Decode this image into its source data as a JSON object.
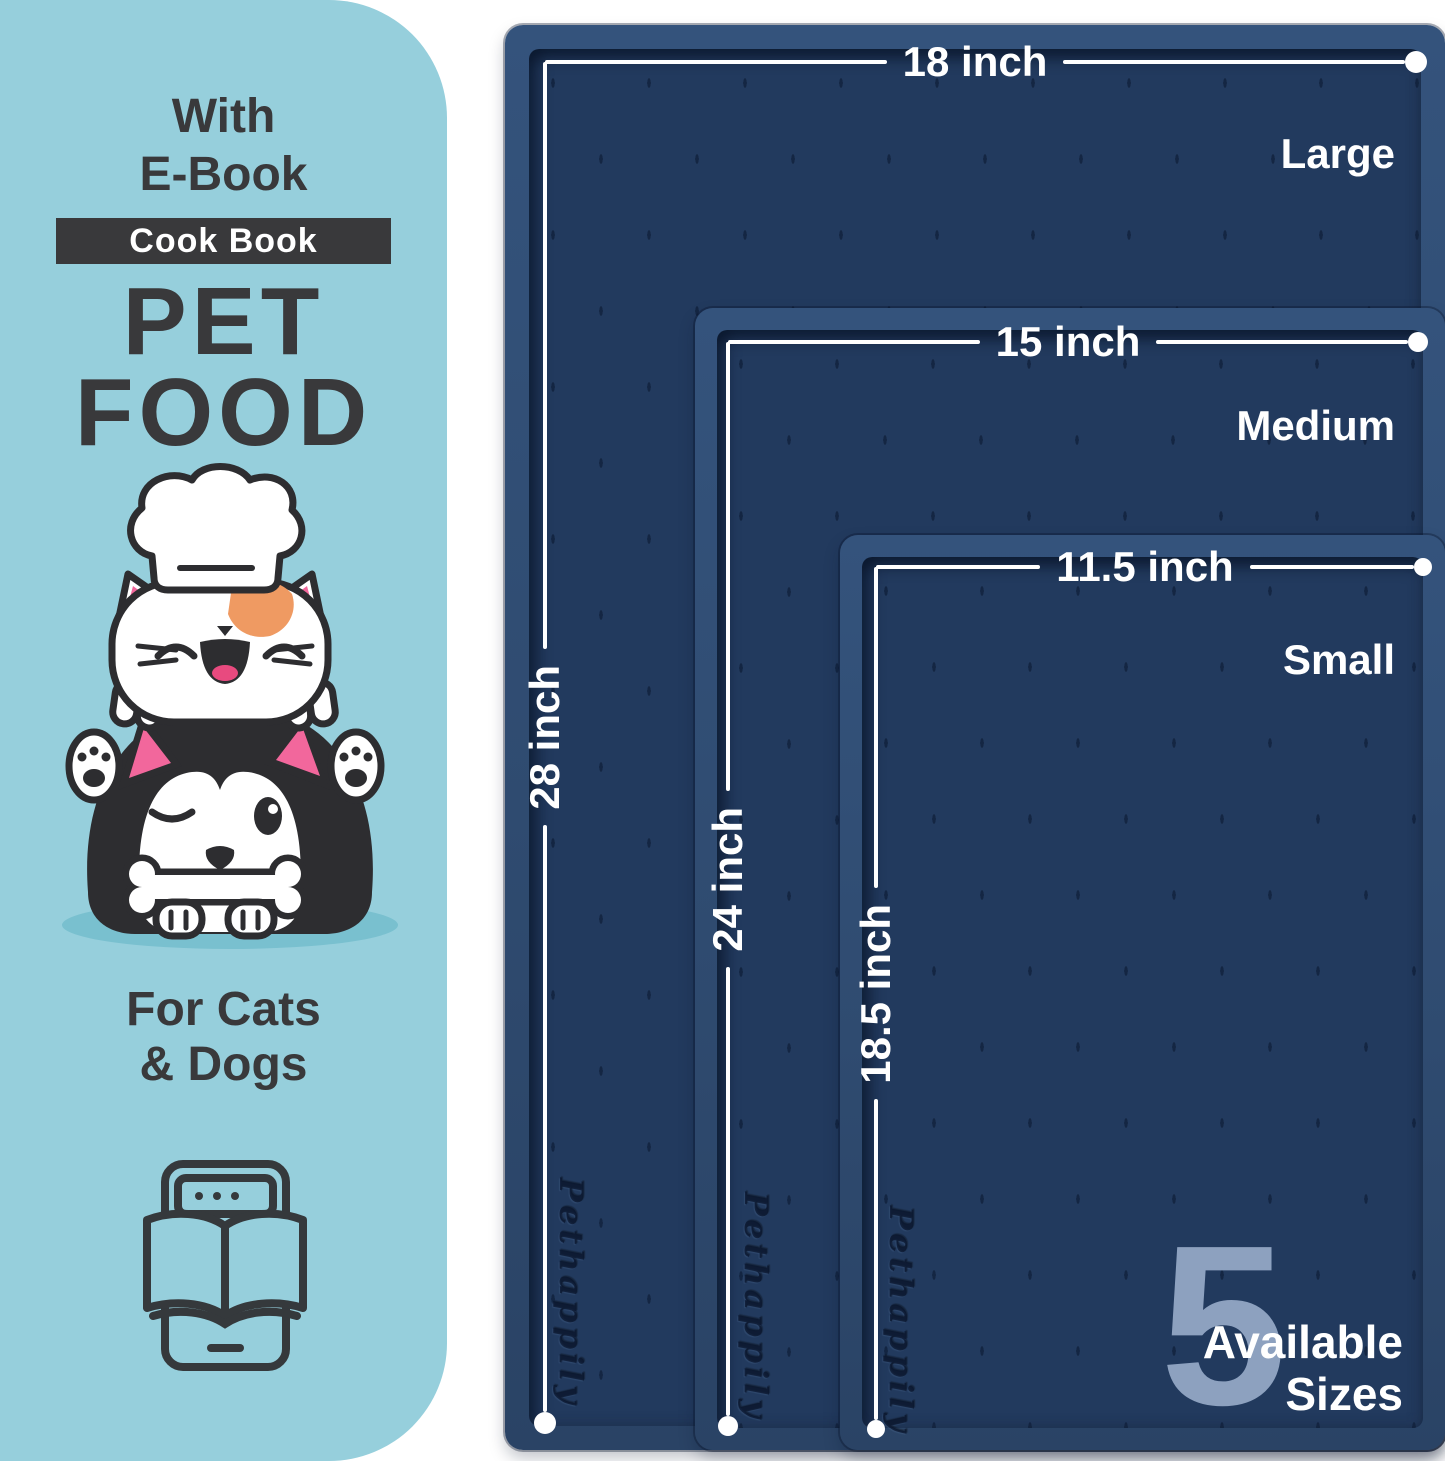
{
  "panel": {
    "with_line1": "With",
    "with_line2": "E-Book",
    "badge": "Cook Book",
    "title_line1": "PET",
    "title_line2": "FOOD",
    "subtitle_line1": "For Cats",
    "subtitle_line2": "& Dogs"
  },
  "mats": [
    {
      "name": "Large",
      "width_label": "18 inch",
      "height_label": "28 inch"
    },
    {
      "name": "Medium",
      "width_label": "15 inch",
      "height_label": "24 inch"
    },
    {
      "name": "Small",
      "width_label": "11.5 inch",
      "height_label": "18.5 inch"
    }
  ],
  "availability": {
    "count": "5",
    "line1": "Available",
    "line2": "Sizes"
  },
  "embossed_brand": "Pethappily",
  "icons": {
    "ebook_icon": "tablet-with-open-book",
    "pets_illustration": "chef-cat-and-winking-husky-with-bone"
  },
  "colors": {
    "panel_bg": "#96cfdc",
    "text_dark": "#39393b",
    "badge_bg": "#39393b",
    "mat_rim": "#2f4b70",
    "mat_surface": "#223a5e",
    "measure_white": "#ffffff",
    "count_watermark": "#8da1bf",
    "cat_patch_orange": "#ef9a62",
    "ear_pink": "#f2679c",
    "tongue_pink": "#e84a7f",
    "pet_shadow": "#79c0cf"
  }
}
